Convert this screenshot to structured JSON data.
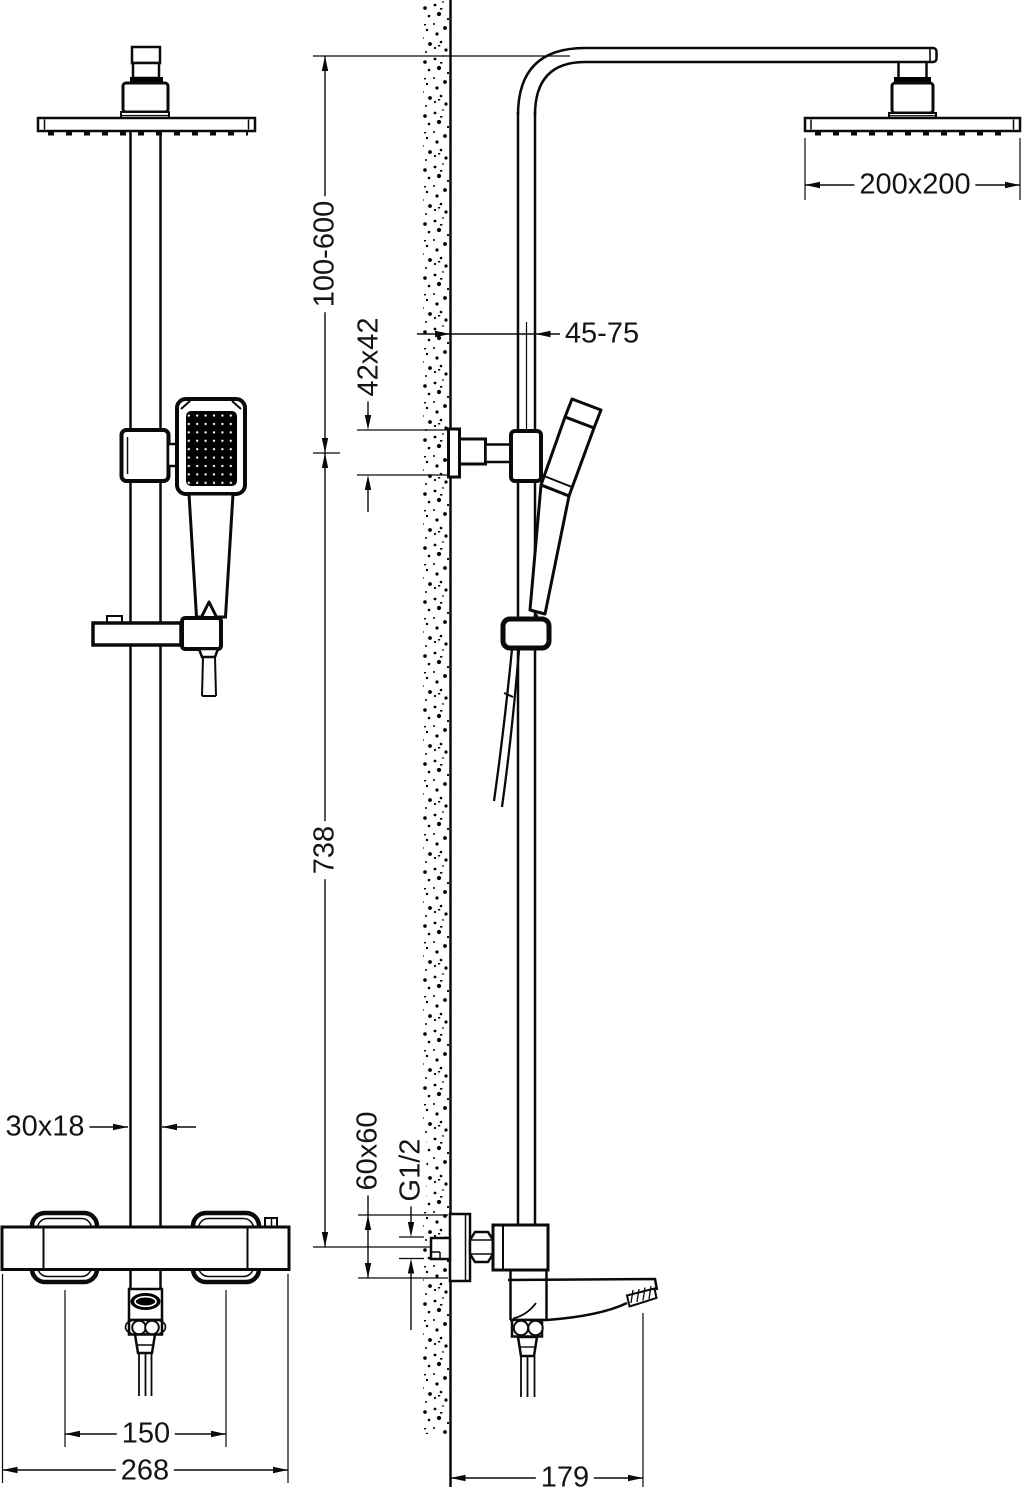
{
  "dims": {
    "head_size": "200x200",
    "height_range": "100-600",
    "wall_distance": "45-75",
    "bracket_size": "42x42",
    "column_height": "738",
    "pipe_section": "30x18",
    "escutcheon_size": "60x60",
    "thread_size": "G1/2",
    "inlet_spacing": "150",
    "mixer_width": "268",
    "spout_depth": "179"
  }
}
